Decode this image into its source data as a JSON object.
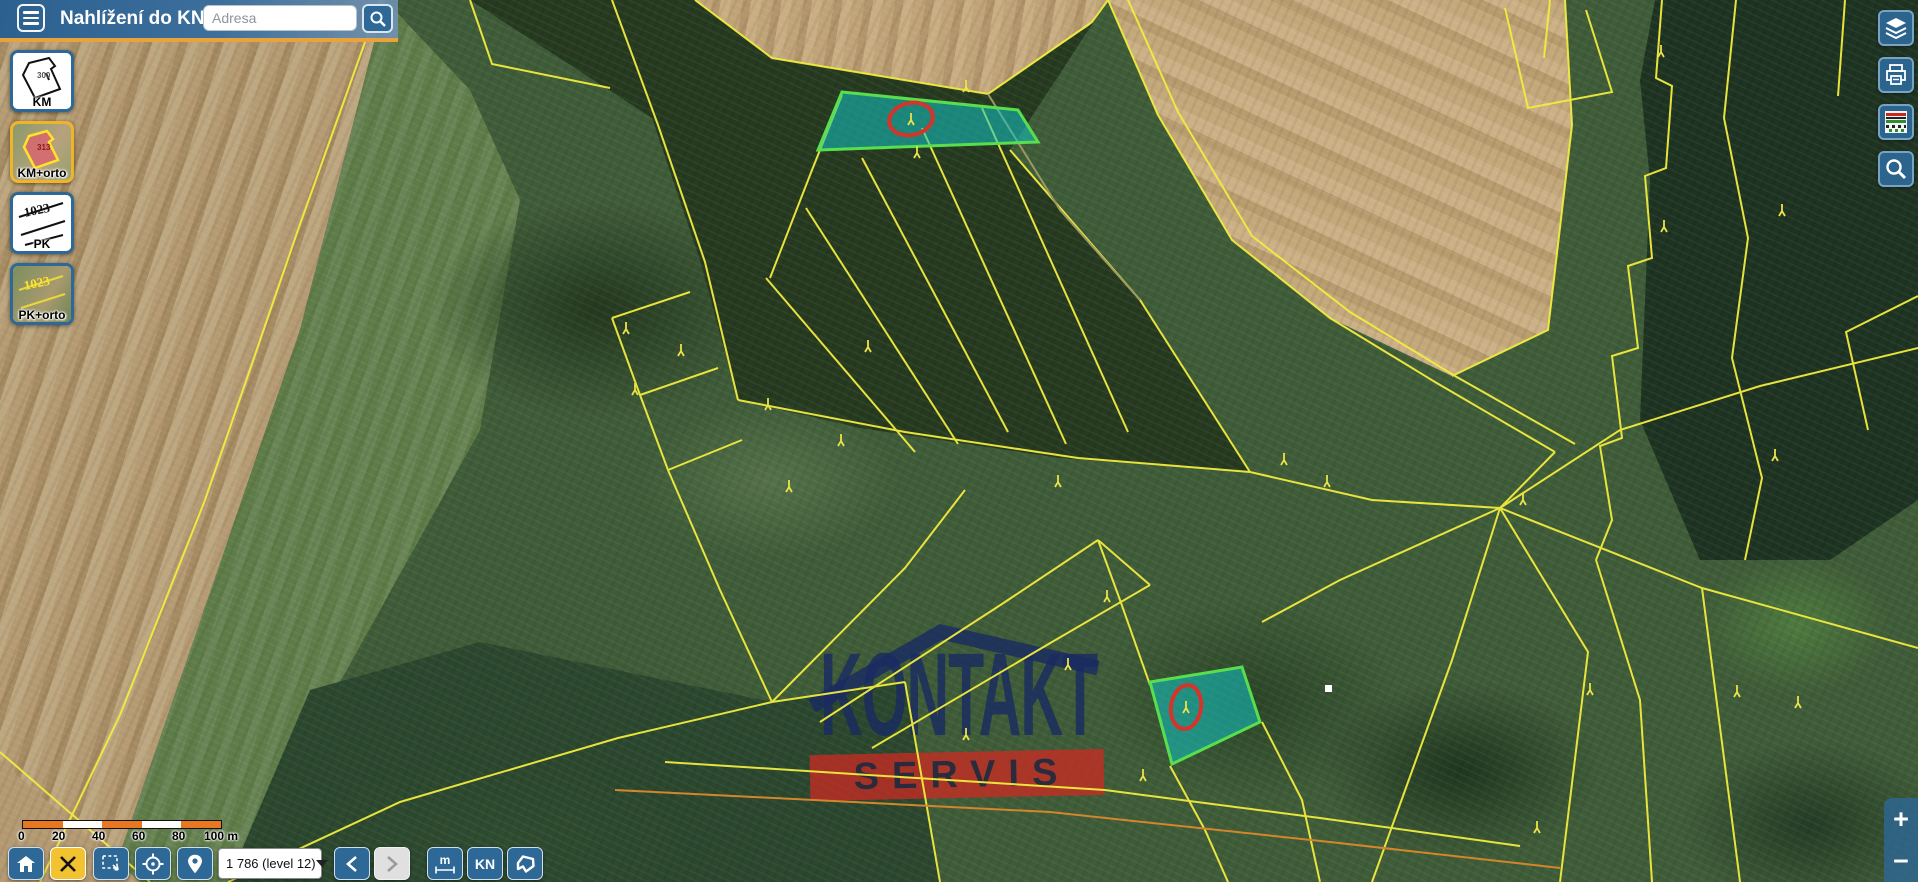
{
  "app": {
    "title": "Nahlížení do KN"
  },
  "search": {
    "placeholder": "Adresa"
  },
  "layer_switcher": {
    "items": [
      {
        "label": "KM",
        "thumb_text": "300",
        "selected": false
      },
      {
        "label": "KM+orto",
        "thumb_text": "313",
        "selected": true
      },
      {
        "label": "PK",
        "thumb_text": "1023",
        "selected": false
      },
      {
        "label": "PK+orto",
        "thumb_text": "1023",
        "selected": false
      }
    ]
  },
  "right_tools": {
    "icons": [
      "layers-icon",
      "print-icon",
      "legend-icon",
      "zoom-search-icon"
    ]
  },
  "scalebar": {
    "ticks": [
      "0",
      "20",
      "40",
      "60",
      "80",
      "100 m"
    ]
  },
  "toolbar": {
    "scale_select_value": "1 786 (level 12)",
    "measure_label": "m",
    "kn_label": "KN"
  },
  "zoom_control": {
    "zoom_in": "+",
    "zoom_out": "−"
  },
  "watermark": {
    "top": "KONTAKT",
    "bottom": "SERVIS"
  },
  "colors": {
    "header_underline": "#e8a33d",
    "button_blue": "#2d6897",
    "active_yellow": "#f2c230",
    "parcel_line": "#f2ec3f",
    "highlight_fill": "#12c4c4",
    "highlight_stroke": "#59de4d",
    "selection_circle": "#d5342b",
    "scalebar_orange": "#e87722"
  }
}
